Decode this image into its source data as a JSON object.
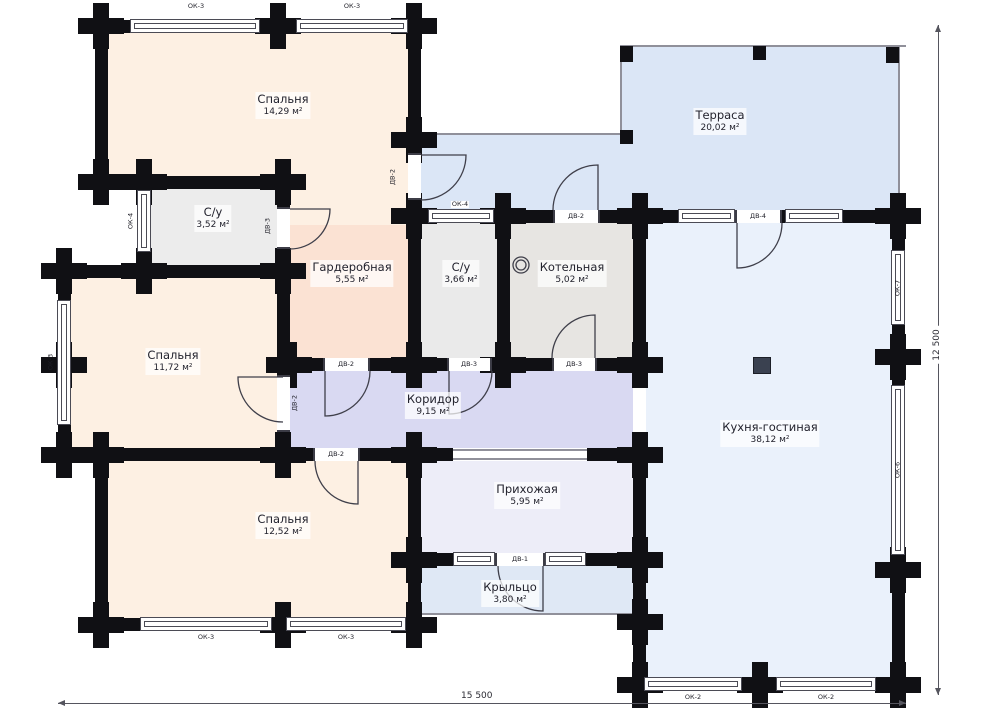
{
  "plan_title": "План 1 этажа",
  "rooms": {
    "bedroom1": {
      "name": "Спальня",
      "area": "14,29 м²"
    },
    "bathroom1": {
      "name": "С/у",
      "area": "3,52 м²"
    },
    "wardrobe": {
      "name": "Гардеробная",
      "area": "5,55 м²"
    },
    "bedroom2": {
      "name": "Спальня",
      "area": "11,72 м²"
    },
    "bathroom2": {
      "name": "С/у",
      "area": "3,66 м²"
    },
    "boiler_room": {
      "name": "Котельная",
      "area": "5,02 м²"
    },
    "terrace": {
      "name": "Терраса",
      "area": "20,02 м²"
    },
    "kitchen_living": {
      "name": "Кухня-гостиная",
      "area": "38,12 м²"
    },
    "corridor": {
      "name": "Коридор",
      "area": "9,15 м²"
    },
    "hallway": {
      "name": "Прихожая",
      "area": "5,95 м²"
    },
    "porch": {
      "name": "Крыльцо",
      "area": "3,80 м²"
    },
    "bedroom3": {
      "name": "Спальня",
      "area": "12,52 м²"
    }
  },
  "windows": {
    "ok2": "ОК-2",
    "ok3": "ОК-3",
    "ok4": "ОК-4",
    "ok6": "ОК-6",
    "ok7": "ОК-7"
  },
  "doors": {
    "dv1": "ДВ-1",
    "dv2": "ДВ-2",
    "dv3": "ДВ-3",
    "dv4": "ДВ-4"
  },
  "dimensions": {
    "width": "15 500",
    "height": "12 500"
  },
  "colors": {
    "bedroom_fill": "#fdf0e3",
    "wardrobe_fill": "#fbe2d3",
    "bath_fill": "#ececec",
    "boiler_fill": "#e7e5e2",
    "terrace_fill": "#dbe6f6",
    "kitchen_fill": "#eaf1fb",
    "corridor_fill": "#d9d9f2",
    "hallway_fill": "#ededf8",
    "porch_fill": "#dfe8f5",
    "wall": "#101014"
  }
}
